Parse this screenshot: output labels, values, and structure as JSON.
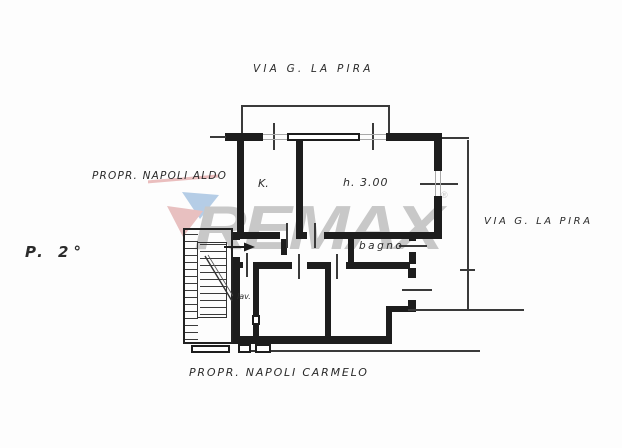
{
  "plan": {
    "labels": {
      "street_top": "VIA G. LA PIRA",
      "street_right": "VIA G. LA PIRA",
      "owner_left": "PROPR. NAPOLI ALDO",
      "owner_bottom": "PROPR. NAPOLI CARMELO",
      "floor": "P. 2°",
      "kitchen": "K.",
      "height": "h. 3.00",
      "bath": "bagno",
      "laundry": "lav."
    }
  },
  "watermark": {
    "brand": "REMAX",
    "registered_mark": "®",
    "text_color": "#9e9e9e",
    "balloon_top_color": "#7ba7d4",
    "balloon_bottom_color": "#d88f8f",
    "strike_color": "#dc8c8c"
  }
}
